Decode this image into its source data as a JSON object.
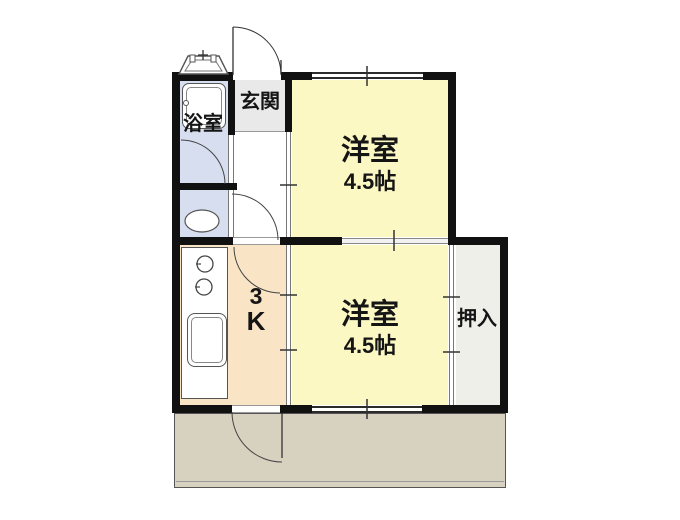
{
  "floorplan": {
    "type": "japanese-apartment-floorplan",
    "plan_name": "3K",
    "rooms": {
      "bathroom": {
        "label": "浴室"
      },
      "entrance": {
        "label": "玄関"
      },
      "western_room_top": {
        "label": "洋室",
        "size": "4.5帖"
      },
      "western_room_bottom": {
        "label": "洋室",
        "size": "4.5帖"
      },
      "kitchen": {
        "label_line1": "3",
        "label_line2": "K"
      },
      "closet": {
        "label": "押入"
      }
    },
    "fixtures": [
      "bathtub",
      "toilet",
      "kitchen-sink",
      "stove-burners",
      "water-heater",
      "balcony"
    ],
    "colors": {
      "room_yellow": "#FBF8C3",
      "kitchen_peach": "#F9E4C6",
      "wet_area_blue": "#D7DEEF",
      "entrance_gray": "#E9E9E9",
      "closet_gray": "#EFEFEA",
      "balcony_tan": "#D7D1BF",
      "wall_black": "#111111"
    }
  }
}
